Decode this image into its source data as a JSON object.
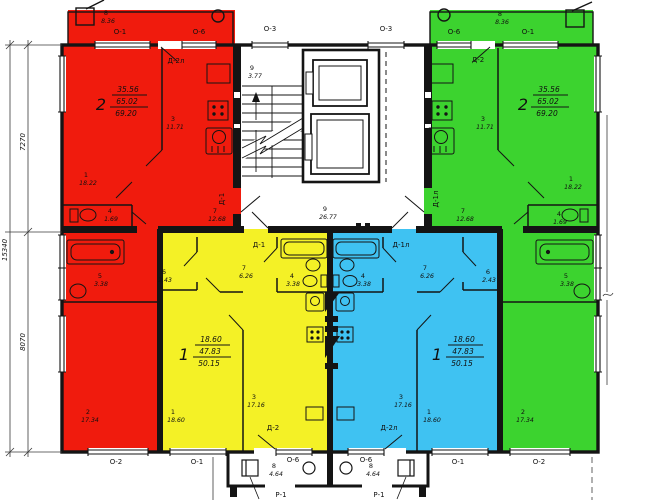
{
  "colors": {
    "red": "#f01b0d",
    "green": "#3cd32f",
    "yellow": "#f4f126",
    "blue": "#3fc2f2",
    "wall": "#141414"
  },
  "flats": {
    "red": {
      "no": "2",
      "living": "35.56",
      "total": "65.02",
      "overall": "69.20",
      "r1": {
        "no": "1",
        "area": "18.22"
      },
      "r2": {
        "no": "2",
        "area": "17.34"
      },
      "r3": {
        "no": "3",
        "area": "11.71"
      },
      "r4": {
        "no": "4",
        "area": "1.69"
      },
      "r5": {
        "no": "5",
        "area": "3.38"
      },
      "r7": {
        "no": "7",
        "area": "12.68"
      },
      "r8": {
        "no": "8",
        "area": "8.36"
      },
      "balcony_door": "Д-2л",
      "entry_door": "Д-1"
    },
    "green": {
      "no": "2",
      "living": "35.56",
      "total": "65.02",
      "overall": "69.20",
      "r1": {
        "no": "1",
        "area": "18.22"
      },
      "r2": {
        "no": "2",
        "area": "17.34"
      },
      "r3": {
        "no": "3",
        "area": "11.71"
      },
      "r4": {
        "no": "4",
        "area": "1.69"
      },
      "r5": {
        "no": "5",
        "area": "3.38"
      },
      "r7": {
        "no": "7",
        "area": "12.68"
      },
      "r8": {
        "no": "8",
        "area": "8.36"
      },
      "balcony_door": "Д-2",
      "entry_door": "Д-1л"
    },
    "yellow": {
      "no": "1",
      "living": "18.60",
      "total": "47.83",
      "overall": "50.15",
      "r1": {
        "no": "1",
        "area": "18.60"
      },
      "r3": {
        "no": "3",
        "area": "17.16"
      },
      "r4": {
        "no": "4",
        "area": "3.38"
      },
      "r6": {
        "no": "6",
        "area": "2.43"
      },
      "r7": {
        "no": "7",
        "area": "6.26"
      },
      "entry_door": "Д-1",
      "balcony_door": "Д-2"
    },
    "blue": {
      "no": "1",
      "living": "18.60",
      "total": "47.83",
      "overall": "50.15",
      "r1": {
        "no": "1",
        "area": "18.60"
      },
      "r3": {
        "no": "3",
        "area": "17.16"
      },
      "r4": {
        "no": "4",
        "area": "3.38"
      },
      "r6": {
        "no": "6",
        "area": "2.43"
      },
      "r7": {
        "no": "7",
        "area": "6.26"
      },
      "entry_door": "Д-1л",
      "balcony_door": "Д-2л"
    }
  },
  "common": {
    "stairs": {
      "no": "9",
      "area": "3.77"
    },
    "corridor": {
      "no": "9",
      "area": "26.77"
    },
    "vest_left": {
      "no": "8",
      "area": "4.64",
      "door": "Р-1"
    },
    "vest_right": {
      "no": "8",
      "area": "4.64",
      "door": "Р-1"
    }
  },
  "windows": {
    "top": [
      "О-1",
      "О-6",
      "О-3",
      "О-3",
      "О-6",
      "О-1"
    ],
    "bottom": [
      "О-2",
      "О-1",
      "О-6",
      "О-6",
      "О-1",
      "О-2"
    ]
  },
  "dims": {
    "upper": "7270",
    "lower": "8070",
    "overall": "15340"
  }
}
